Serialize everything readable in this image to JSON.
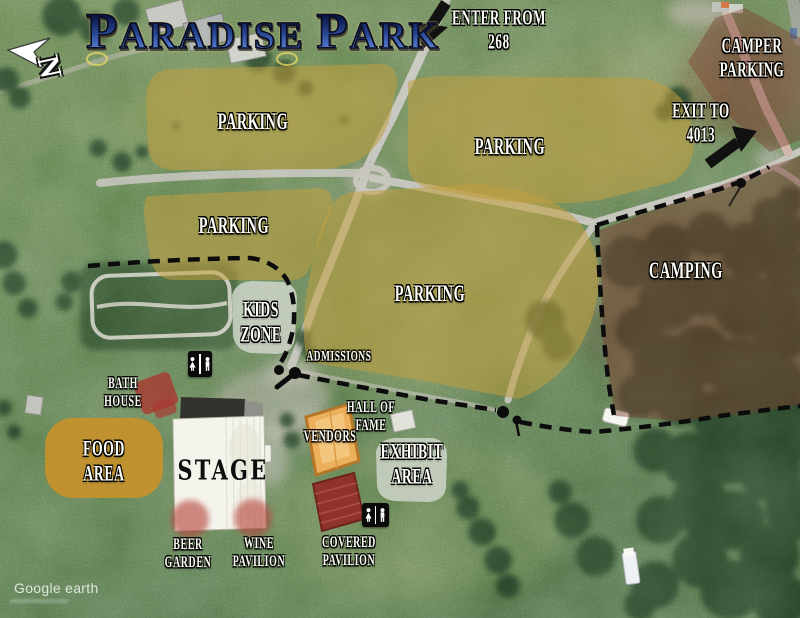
{
  "map_title": {
    "words": [
      "Paradise",
      "Park"
    ]
  },
  "compass": {
    "letter": "N"
  },
  "directions": {
    "enter": "ENTER FROM\n268",
    "exit": "EXIT TO\n4013"
  },
  "areas": {
    "parking": "PARKING",
    "camper_parking": "CAMPER\nPARKING",
    "camping": "CAMPING",
    "kids_zone": "KIDS\nZONE",
    "food_area": "FOOD\nAREA",
    "exhibit_area": "EXHIBIT\nAREA"
  },
  "facilities": {
    "admissions": "ADMISSIONS",
    "bath_house": "BATH\nHOUSE",
    "stage": "STAGE",
    "vendors": "VENDORS",
    "hall_of_fame": "HALL OF\nFAME",
    "covered_pavilion": "COVERED\nPAVILION",
    "beer_garden": "BEER\nGARDEN",
    "wine_pavilion": "WINE\nPAVILION"
  },
  "watermark": {
    "brand": "Google earth"
  },
  "colors": {
    "parking_overlay": "#c19f3e",
    "camping_overlay": "#7a3a2c",
    "food_area_overlay": "#c8912a",
    "zone_overlay": "#ccd3c6",
    "highlight_red": "#b5443c",
    "boundary_dash": "#0c0c0c",
    "road_gray": "#b9b9af",
    "camper_road_pink": "#c9a698",
    "title_blue": "#2c52b0",
    "label_text": "#ffffff"
  }
}
